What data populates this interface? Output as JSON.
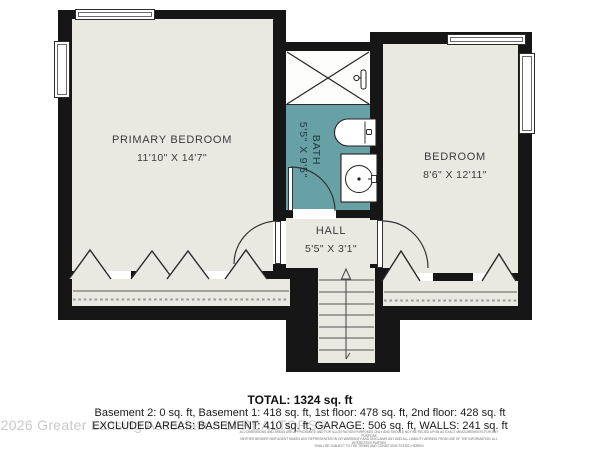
{
  "rooms": {
    "primary_bedroom": {
      "label": "PRIMARY BEDROOM",
      "dims": "11'10\" X 14'7\""
    },
    "bedroom": {
      "label": "BEDROOM",
      "dims": "8'6\" X 12'11\""
    },
    "bath": {
      "label": "BATH",
      "dims": "5'5\" X 9'5\""
    },
    "hall": {
      "label": "HALL",
      "dims": "5'5\" X 3'1\""
    }
  },
  "summary": {
    "total": "TOTAL: 1324 sq. ft",
    "floors": "Basement 2: 0 sq. ft, Basement 1: 418 sq. ft, 1st floor: 478 sq. ft, 2nd floor: 428 sq. ft",
    "excluded": "EXCLUDED AREAS: BASEMENT: 410 sq. ft, GARAGE: 506 sq. ft, WALLS: 241 sq. ft",
    "fine_print": [
      "ALL DIMENSIONS AND AREAS ARE APPROXIMATE AND FOR ILLUSTRATION PURPOSES ONLY AND SHOULD NOT BE RELIED UPON AS EXACT MEASUREMENTS FOR ANY PURPOSE",
      "NEITHER BROKER NOR AGENT MAKES ANY REPRESENTATION OR WARRANTY AND DISCLAIMS ANY AND ALL LIABILITY ARISING FROM USE OF THE INFORMATION. ALL INTERESTED PARTIES",
      "SHALL BE SUBJECT TO THE TERMS AND CONDITIONS STATED HEREIN"
    ]
  },
  "watermark": {
    "text": "©2026 Greater Lansing Association of REALTORS®"
  },
  "colors": {
    "wall": "#161616",
    "room_fill": "#e9e8e1",
    "bath_fill": "#67a0a5",
    "watermark": "#c9c9c9"
  }
}
